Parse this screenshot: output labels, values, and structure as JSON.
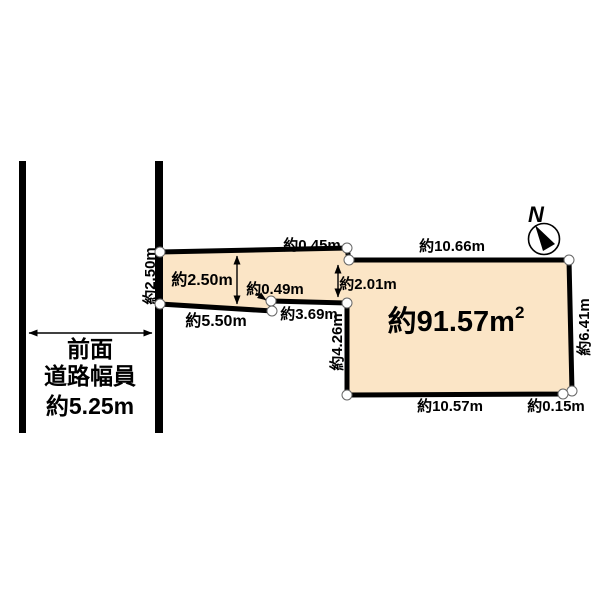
{
  "diagram": {
    "background_color": "#ffffff",
    "parcel": {
      "area_value": "約91.57m",
      "area_superscript": "2",
      "fill_color": "#FBE5C6",
      "outline_color": "#000000"
    },
    "north": {
      "label": "N"
    },
    "road": {
      "label_line1": "前面",
      "label_line2": "道路幅員",
      "label_line3": "約5.25m"
    },
    "dimensions": {
      "strip_depth_at_road": "約2.50m",
      "strip_depth_inner": "約2.50m",
      "top_step": "約0.45m",
      "top_edge": "約10.66m",
      "bottom_step": "約0.49m",
      "strip_bottom_near": "約5.50m",
      "strip_bottom_far": "約3.69m",
      "step_depth": "約2.01m",
      "inner_left_edge": "約4.26m",
      "right_edge": "約6.41m",
      "bottom_edge": "約10.57m",
      "bottom_right_step": "約0.15m"
    }
  }
}
